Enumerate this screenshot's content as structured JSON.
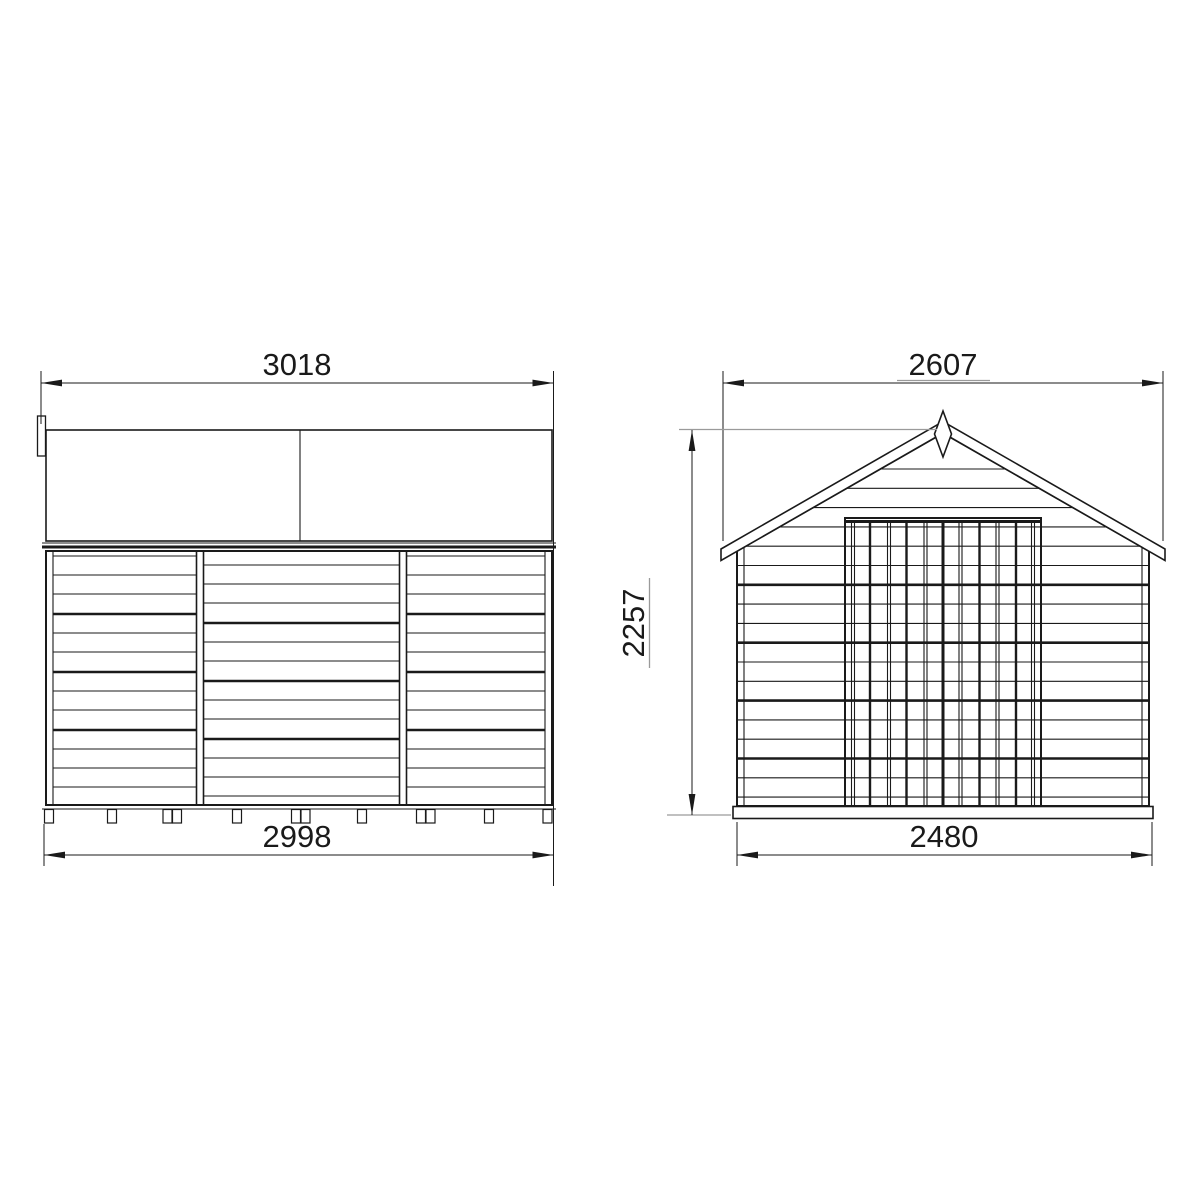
{
  "views": {
    "side_elevation": {
      "roof_width_label": "3018",
      "base_width_label": "2998"
    },
    "front_elevation": {
      "roof_width_label": "2607",
      "height_label": "2257",
      "base_width_label": "2480"
    }
  },
  "colors": {
    "background": "#ffffff",
    "line": "#1a1a1a",
    "dim_extension_gray": "#9a9a9a"
  }
}
